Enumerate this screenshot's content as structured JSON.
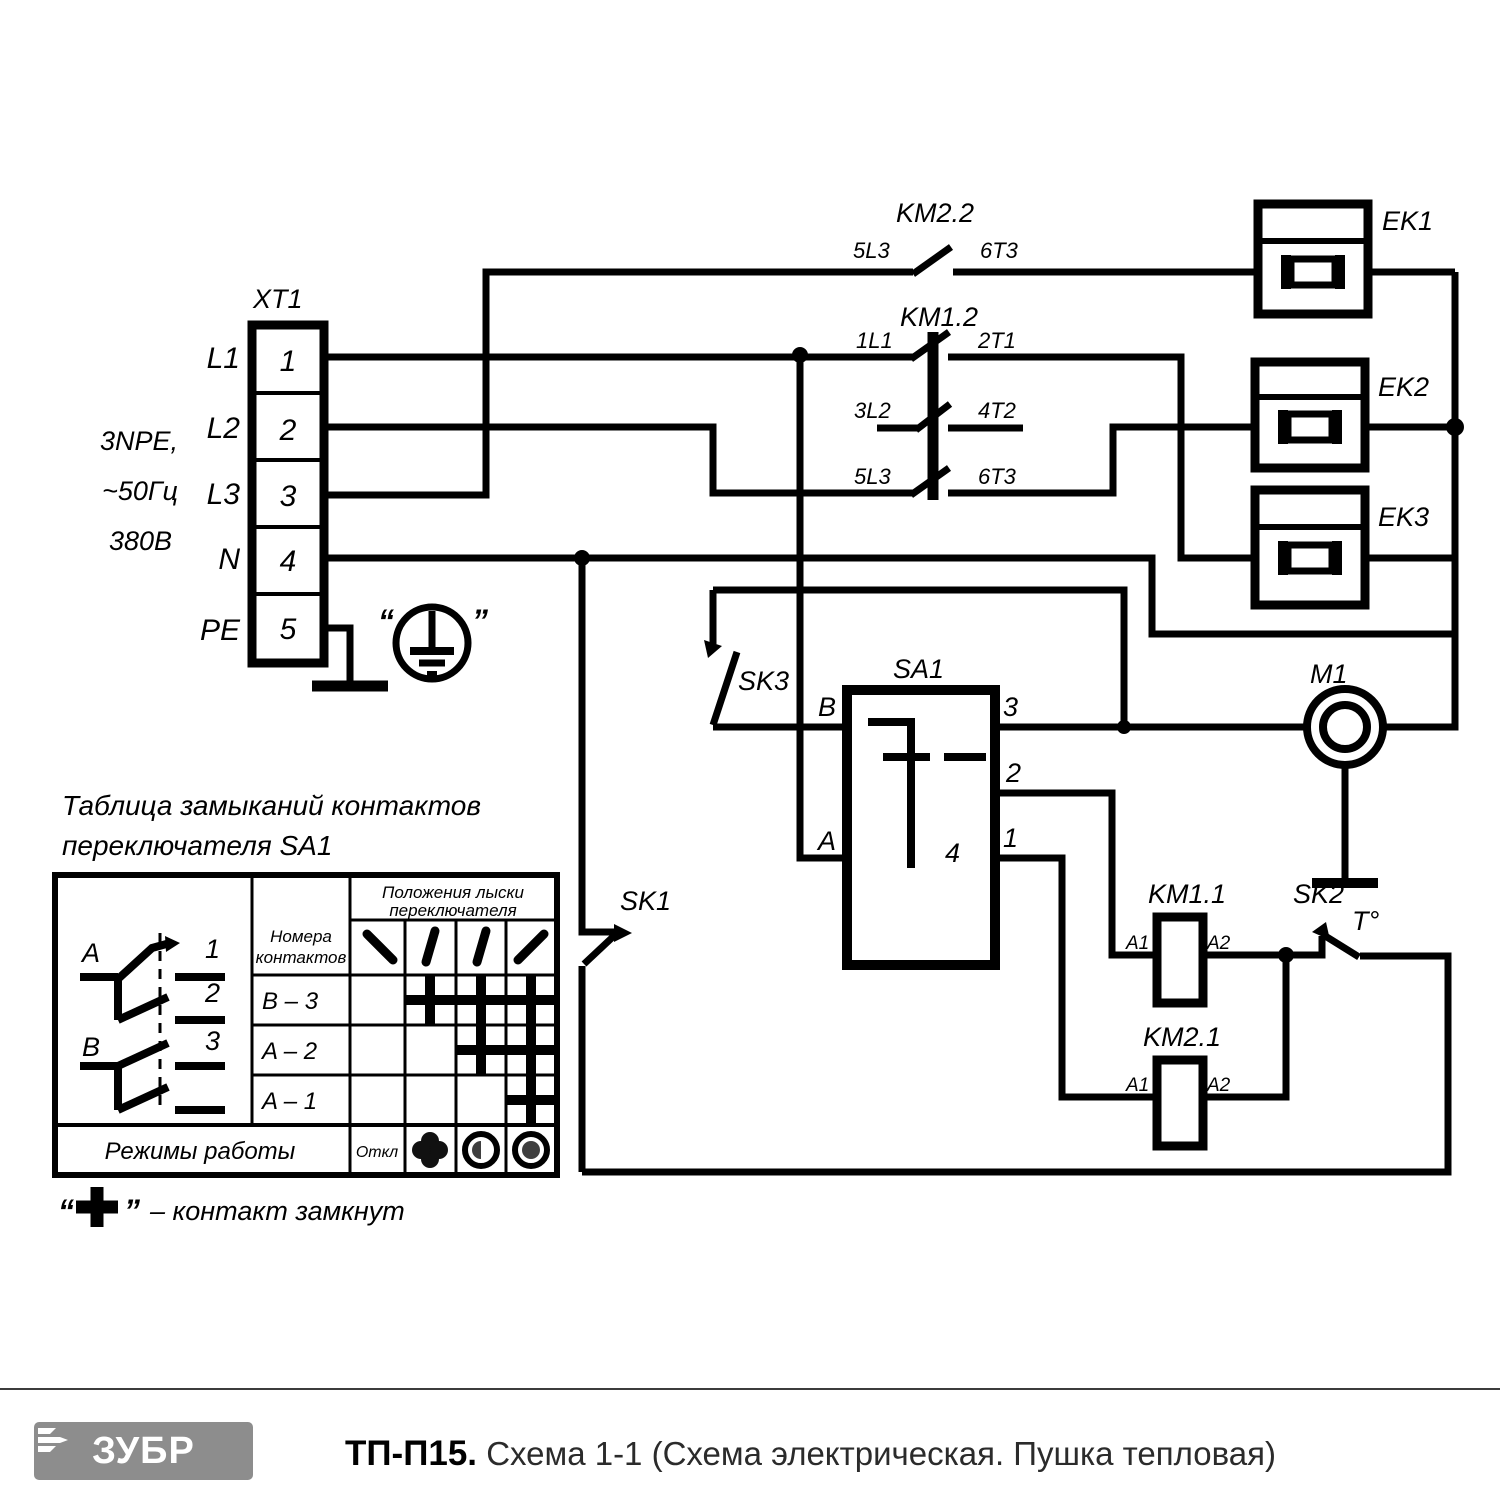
{
  "schematic": {
    "xt1": {
      "label": "XT1",
      "terminals": [
        {
          "n": "1",
          "line": "L1"
        },
        {
          "n": "2",
          "line": "L2"
        },
        {
          "n": "3",
          "line": "L3"
        },
        {
          "n": "4",
          "line": "N"
        },
        {
          "n": "5",
          "line": "PE"
        }
      ],
      "supply": [
        "3NPE,",
        "~50Гц",
        "380В"
      ],
      "ground_quote_left": "“",
      "ground_quote_right": "”"
    },
    "km22": {
      "label": "KM2.2",
      "in": "5L3",
      "out": "6T3"
    },
    "km12": {
      "label": "KM1.2",
      "poles": [
        {
          "in": "1L1",
          "out": "2T1"
        },
        {
          "in": "3L2",
          "out": "4T2"
        },
        {
          "in": "5L3",
          "out": "6T3"
        }
      ]
    },
    "heaters": [
      {
        "label": "EK1"
      },
      {
        "label": "EK2"
      },
      {
        "label": "EK3"
      }
    ],
    "motor": {
      "label": "M1"
    },
    "sa1": {
      "label": "SA1",
      "t_b": "B",
      "t_a": "A",
      "t3": "3",
      "t2": "2",
      "t1": "1",
      "t4": "4"
    },
    "sk1": {
      "label": "SK1"
    },
    "sk2": {
      "label": "SK2",
      "temp": "T°"
    },
    "sk3": {
      "label": "SK3"
    },
    "km11": {
      "label": "KM1.1",
      "a1": "A1",
      "a2": "A2"
    },
    "km21": {
      "label": "KM2.1",
      "a1": "A1",
      "a2": "A2"
    }
  },
  "table": {
    "title1": "Таблица замыканий контактов",
    "title2": "переключателя SA1",
    "col_contacts_1": "Номера",
    "col_contacts_2": "контактов",
    "col_positions_1": "Положения лыски",
    "col_positions_2": "переключателя",
    "diagram": {
      "a": "A",
      "b": "B",
      "c1": "1",
      "c2": "2",
      "c3": "3"
    },
    "rows": [
      {
        "name": "B – 3",
        "marks": [
          false,
          true,
          true,
          true
        ]
      },
      {
        "name": "A – 2",
        "marks": [
          false,
          false,
          true,
          true
        ]
      },
      {
        "name": "A – 1",
        "marks": [
          false,
          false,
          false,
          true
        ]
      }
    ],
    "modes_label": "Режимы работы",
    "mode_off": "Откл",
    "legend": {
      "q1": "“",
      "q2": "”",
      "text": "– контакт замкнут"
    }
  },
  "footer": {
    "brand": "ЗУБР",
    "model": "ТП-П15.",
    "caption": "Схема 1-1 (Схема электрическая. Пушка тепловая)"
  }
}
